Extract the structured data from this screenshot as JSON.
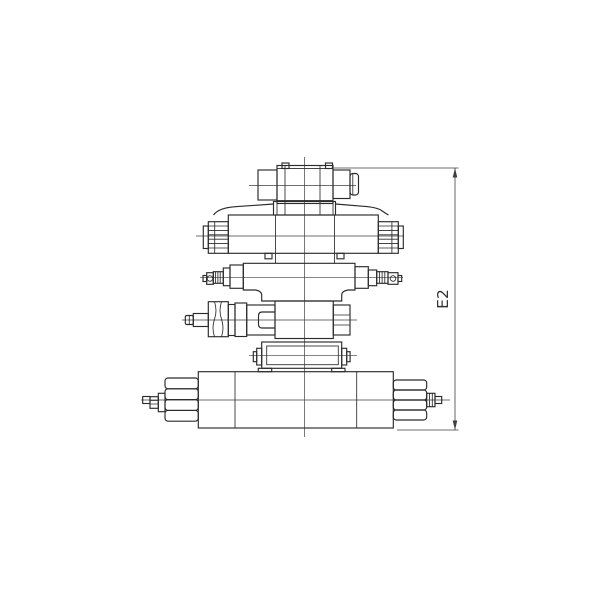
{
  "diagram": {
    "type": "engineering-drawing",
    "description": "Side view of a stacked hydraulic modular valve assembly mounted on a base plate",
    "background_color": "#ffffff",
    "line_color": "#2b2b2b",
    "centerline_color": "#3f3f3f",
    "dimension": {
      "label": "E2",
      "side": "right",
      "orientation": "vertical"
    },
    "parts": {
      "tier1": "top solenoid block",
      "tier2": "directional valve body with solenoid ends",
      "tier3": "throttle module with adjustment screws",
      "tier4": "pressure module with adjuster and hex plug",
      "tier5": "adapter block",
      "tier6": "base plate with tie-rod nuts and studs"
    }
  }
}
